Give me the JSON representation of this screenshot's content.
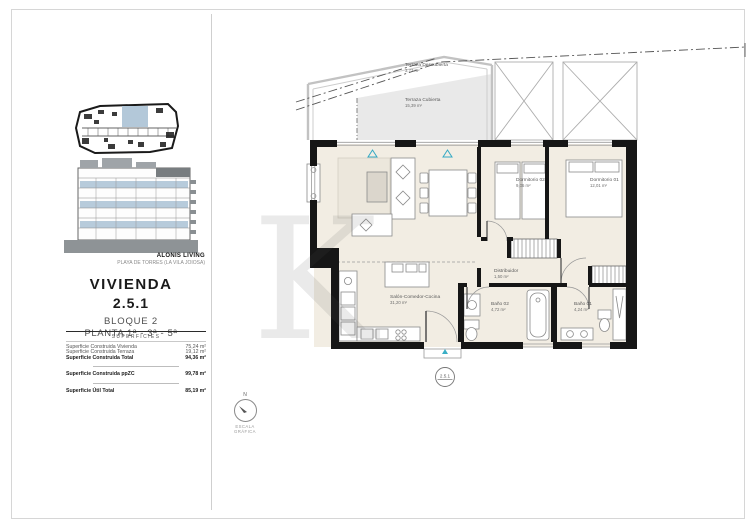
{
  "brand": {
    "name": "ALONIS LIVING",
    "location": "PLAYA DE TORRES (LA VILA JOIOSA)"
  },
  "unit": {
    "title": "VIVIENDA",
    "number": "2.5.1",
    "block": "BLOQUE 2",
    "floors": "PLANTA 1ª - 3ª - 5ª"
  },
  "surfaces": {
    "heading": "SUPERFICIES",
    "rows": [
      {
        "label": "Superficie Construida Vivienda",
        "value": "75,24 m²"
      },
      {
        "label": "Superficie Construida Terraza",
        "value": "19,12 m²"
      },
      {
        "label": "Superficie Construida Total",
        "value": "94,36 m²"
      },
      {
        "label": "Superficie Construida ppZC",
        "value": "99,78 m²"
      },
      {
        "label": "Superficie Útil Total",
        "value": "85,19 m²"
      }
    ]
  },
  "compass": {
    "north_label": "N",
    "caption": "ESCALA GRÁFICA"
  },
  "plan": {
    "badge": "2.5.1",
    "rooms": [
      {
        "name": "Terraza Descubierta",
        "area": "3,73 m²"
      },
      {
        "name": "Terraza Cubierta",
        "area": "15,39 m²"
      },
      {
        "name": "Salón-Comedor-Cocina",
        "area": "31,20 m²"
      },
      {
        "name": "Dormitorio 02",
        "area": "9,06 m²"
      },
      {
        "name": "Dormitorio 01",
        "area": "12,01 m²"
      },
      {
        "name": "Distribuidor",
        "area": "1,50 m²"
      },
      {
        "name": "Baño 02",
        "area": "4,72 m²"
      },
      {
        "name": "Baño 01",
        "area": "4,24 m²"
      }
    ]
  },
  "watermark": "K",
  "colors": {
    "highlight_blue": "#b3c8d9",
    "vent_cyan": "#33a9c4",
    "wall_black": "#161616"
  }
}
